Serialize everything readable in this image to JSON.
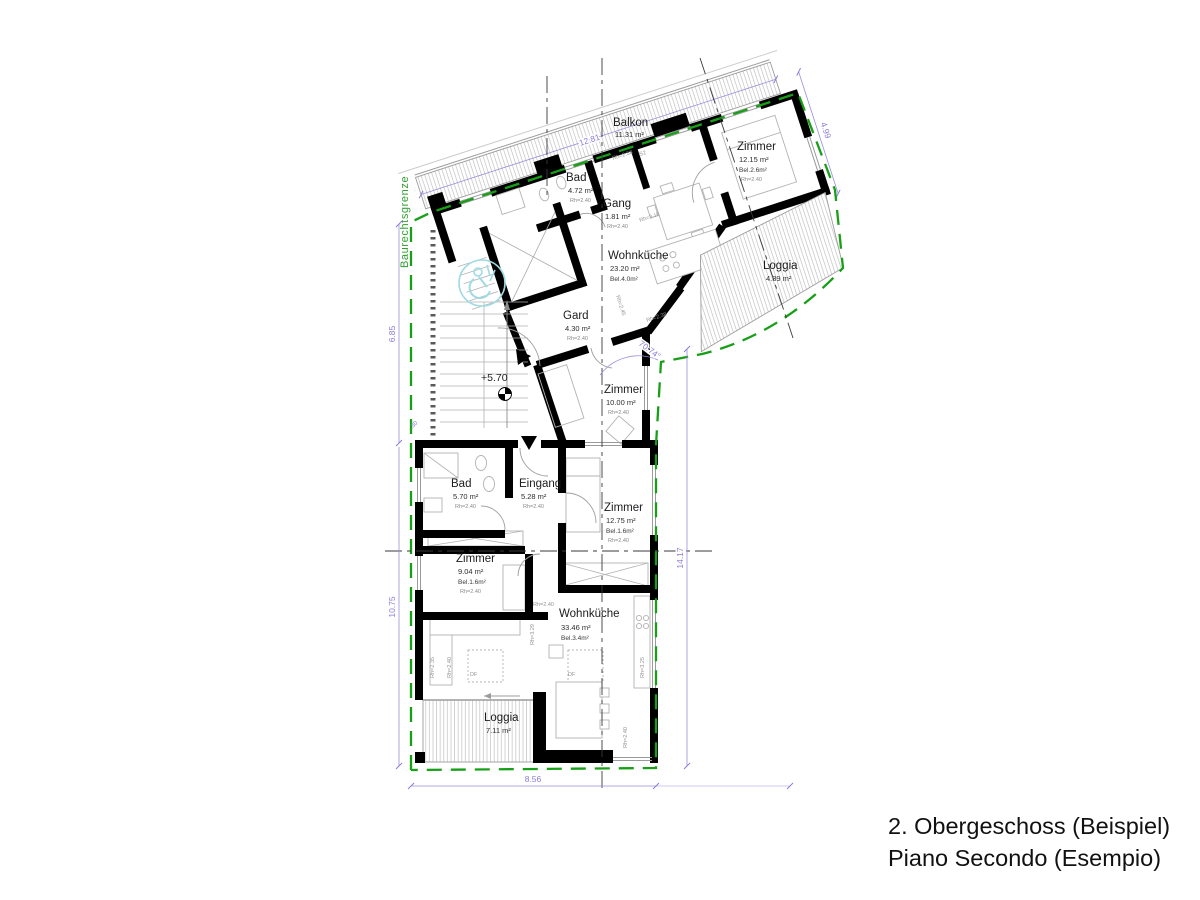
{
  "title": {
    "line1": "2. Obergeschoss (Beispiel)",
    "line2": "Piano Secondo (Esempio)"
  },
  "site": {
    "boundary_label": "Baurechtsgrenze",
    "level_marker": "+5.70",
    "angle": "70.74°"
  },
  "dimensions": {
    "balcony": "12.81",
    "wing_right": "4.99",
    "left_upper": "6.85",
    "left_offset": ".30",
    "left_lower": "10.75",
    "right": "14.17",
    "bottom": "8.56"
  },
  "rooms": {
    "balkon": {
      "name": "Balkon",
      "area": "11.31 m²"
    },
    "bad_og": {
      "name": "Bad",
      "area": "4.72 m²",
      "rh": "Rh=2.40"
    },
    "gang": {
      "name": "Gang",
      "area": "1.81 m²",
      "rh": "Rh=2.40"
    },
    "wohnkueche_og": {
      "name": "Wohnküche",
      "area": "23.20 m²",
      "bel": "Bel.4.0m²"
    },
    "zimmer_og": {
      "name": "Zimmer",
      "area": "12.15 m²",
      "bel": "Bel.2.6m²",
      "rh": "Rh=2.40"
    },
    "loggia_og": {
      "name": "Loggia",
      "area": "4.39 m²"
    },
    "gard": {
      "name": "Gard",
      "area": "4.30 m²",
      "rh": "Rh=2.40"
    },
    "zimmer_mitte": {
      "name": "Zimmer",
      "area": "10.00 m²",
      "rh": "Rh=2.40"
    },
    "bad_eg": {
      "name": "Bad",
      "area": "5.70 m²",
      "rh": "Rh=2.40"
    },
    "eingang": {
      "name": "Eingang",
      "area": "5.28 m²",
      "rh": "Rh=2.40"
    },
    "zimmer_ost": {
      "name": "Zimmer",
      "area": "12.75 m²",
      "bel": "Bel.1.6m²",
      "rh": "Rh=2.40"
    },
    "zimmer_west": {
      "name": "Zimmer",
      "area": "9.04 m²",
      "bel": "Bel.1.6m²",
      "rh": "Rh=2.40"
    },
    "wohnkueche_ug": {
      "name": "Wohnküche",
      "area": "33.46 m²",
      "bel": "Bel.3.4m²"
    },
    "loggia_ug": {
      "name": "Loggia",
      "area": "7.11 m²"
    }
  },
  "annotations": [
    {
      "text": "Rh=2.58"
    },
    {
      "text": "S2"
    },
    {
      "text": "Rh=3.15"
    },
    {
      "text": "Rh=2.45"
    },
    {
      "text": "Rh=2.38"
    },
    {
      "text": "Rh=2.40"
    },
    {
      "text": "Rh=3.29"
    },
    {
      "text": "Rh=3.25"
    },
    {
      "text": "Rh=2.40"
    },
    {
      "text": "Rh=2.35"
    },
    {
      "text": "Rh=2.40"
    },
    {
      "text": "DF"
    },
    {
      "text": "DF"
    }
  ],
  "colors": {
    "boundary_green": "#17a017",
    "dimension_purple": "#8a7cd8",
    "wall_black": "#000000",
    "accessibility_teal": "#9fdbe3"
  }
}
